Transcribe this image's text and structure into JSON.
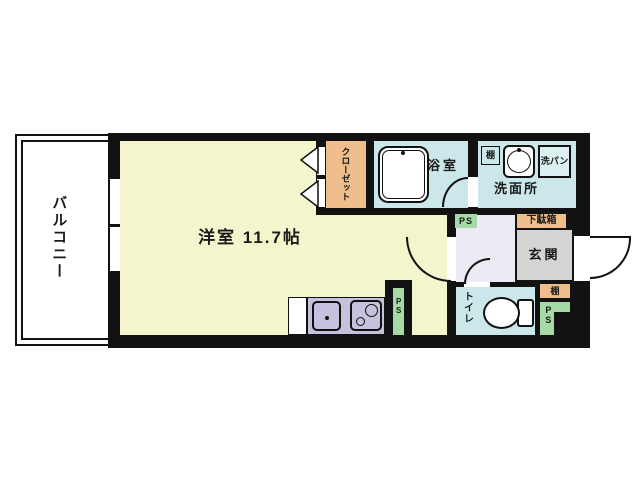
{
  "title": "1R apartment floor plan",
  "labels": {
    "balcony": "バルコニー",
    "main_room": "洋室 11.7帖",
    "closet": "クローゼット",
    "bathroom": "浴室",
    "washroom": "洗面所",
    "washing_pan": "洗パン",
    "shelf_washroom": "棚",
    "shoe_cabinet": "下駄箱",
    "entrance": "玄関",
    "shelf_entrance": "棚",
    "toilet": "トイレ",
    "ps_hall": "PS",
    "ps_kitchen": "PS",
    "ps_toilet": "PS"
  },
  "colors": {
    "wall": "#121212",
    "room_cream": "#F5F5CD",
    "closet_orange": "#F0BE8C",
    "water_blue": "#CBE7E9",
    "pan_blue": "#DCF0F1",
    "kitchen_lavender": "#C6C1DC",
    "hallway_lavender": "#ECEAF2",
    "entrance_gray": "#D4D4D4",
    "ps_green": "#A5D9A5"
  }
}
